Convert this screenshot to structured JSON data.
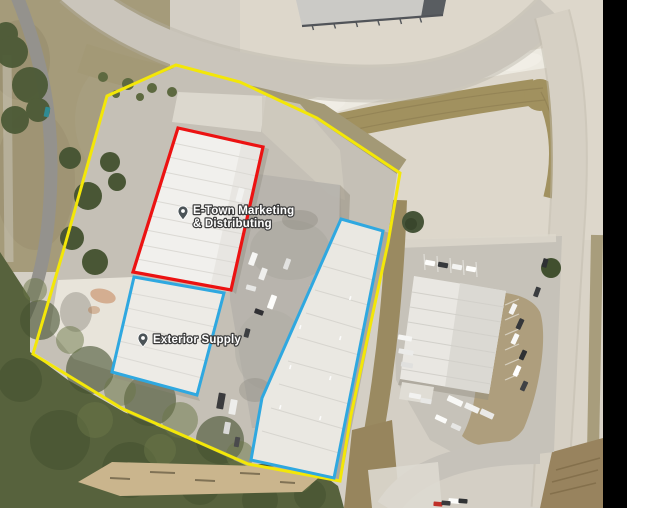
{
  "canvas": {
    "width": 650,
    "height": 508,
    "black_margin_color": "#000000",
    "white_margin_color": "#ffffff"
  },
  "map": {
    "kind": "satellite-aerial-imagery",
    "labels": [
      {
        "id": "etown",
        "line1": "E-Town Marketing",
        "line2": "& Distributing",
        "icon": "place-pin-icon",
        "text_color": "#ffffff",
        "halo_color": "#3d3d3d",
        "pin_color": "#4b5357"
      },
      {
        "id": "exterior-supply",
        "line1": "Exterior Supply",
        "icon": "place-pin-icon",
        "text_color": "#ffffff",
        "halo_color": "#3d3d3d",
        "pin_color": "#4b5357"
      }
    ],
    "overlays": {
      "parcel_boundary": {
        "color": "#f3e708",
        "points": "176,65 240,82 317,118 400,173 388,243 351,415 340,481 248,464 123,409 33,354 63,252 107,96"
      },
      "highlight_building": {
        "color": "#ec1212",
        "points": "178,128 263,147 231,290 133,272"
      },
      "outlined_building_south": {
        "color": "#2fa8e0",
        "points": "134,277 224,293 197,395 112,372"
      },
      "outlined_building_east": {
        "color": "#2fa8e0",
        "points": "341,219 383,231 334,478 251,460 262,398"
      }
    }
  }
}
